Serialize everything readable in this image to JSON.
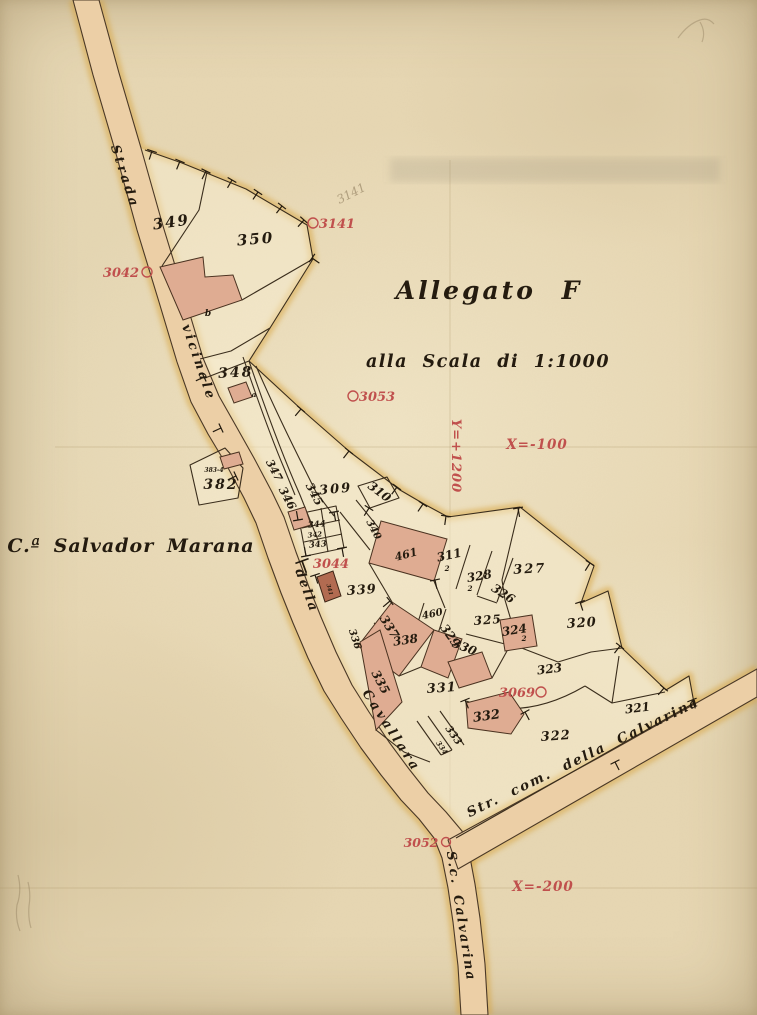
{
  "colors": {
    "paper": "#e7d7b3",
    "road": "#eccfa6",
    "glow": "#d8a33c",
    "building": "#dfac92",
    "building_dark": "#b26b51",
    "red": "#c0504d",
    "ink": "#241b0f",
    "line": "#3a2d1c"
  },
  "title": {
    "allegato": "Allegato F",
    "scale": "alla Scala di 1:1000",
    "place": "C.ª Salvador Marana"
  },
  "roads": {
    "strada": "Strada",
    "vicinale": "vicinale",
    "della": "della",
    "cavallara": "Cavallara",
    "str_com": "Str. com. della Calvarina",
    "sc_calvarina": "S.c. Calvarina"
  },
  "grid": {
    "y1200": "Y=+1200",
    "x100": "X=-100",
    "x200": "X=-200"
  },
  "markers": {
    "m3141": "3141",
    "m3042": "3042",
    "m3053": "3053",
    "m3044": "3044",
    "m3069": "3069",
    "m3052": "3052"
  },
  "pencil": {
    "note3141": "3141"
  },
  "parcels": {
    "p349": "349",
    "p350": "350",
    "p348": "348",
    "p382": "382",
    "p383_4": "383-4",
    "p347": "347",
    "p346": "346",
    "p345": "345",
    "p344": "344",
    "p342": "342",
    "p343": "343",
    "p341": "341",
    "p340": "340",
    "p309": "309",
    "p310": "310",
    "p339": "339",
    "p461": "461",
    "p311": "311",
    "sub311": "2",
    "p328": "328",
    "sub328": "2",
    "p326": "326",
    "p327": "327",
    "p325": "325",
    "p324": "324",
    "sub324": "2",
    "p320": "320",
    "p337": "337",
    "p338": "338",
    "p460": "460",
    "p329": "329",
    "p330": "330",
    "p336": "336",
    "p335": "335",
    "p331": "331",
    "p332": "332",
    "p333": "333",
    "p334": "334",
    "p322": "322",
    "p323": "323",
    "p321": "321",
    "letter_b": "b",
    "letter_a": "a"
  }
}
